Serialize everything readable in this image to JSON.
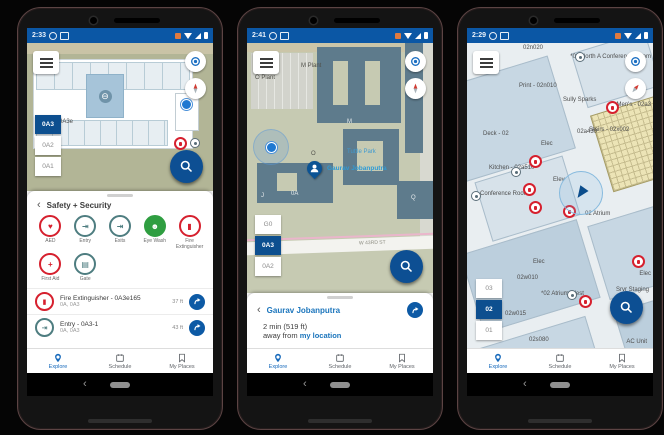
{
  "colors": {
    "status_bar_blue": "#0b57a5",
    "accent_blue": "#0d4f93",
    "nav_active_blue": "#1669bb",
    "poi_red": "#d6202e",
    "poi_teal": "#4e7d80",
    "poi_green": "#2f9e41",
    "person_label_blue": "#2e9bd6",
    "map_olive": "#b2b596",
    "campus_building": "#5e7b8c",
    "stairs_yellow": "#ece4b6"
  },
  "nav": {
    "explore": "Explore",
    "schedule": "Schedule",
    "my_places": "My Places"
  },
  "android": {
    "back_glyph": "‹"
  },
  "phones": [
    {
      "status": {
        "time": "2:33"
      },
      "map": {
        "room_label": "0A3e",
        "floors": {
          "f1": "0A3",
          "f2": "0A2",
          "f3": "0A1"
        }
      },
      "sheet": {
        "back_glyph": "‹",
        "title": "Safety + Security",
        "categories": [
          {
            "label": "AED",
            "glyph": "♥"
          },
          {
            "label": "Entry",
            "glyph": "⇥"
          },
          {
            "label": "Exits",
            "glyph": "⇥"
          },
          {
            "label": "Eye Wash",
            "glyph": "☻"
          },
          {
            "label": "Fire Extinguisher",
            "glyph": "▮"
          },
          {
            "label": "First Aid",
            "glyph": "+"
          },
          {
            "label": "Gate",
            "glyph": "▤"
          }
        ],
        "results": [
          {
            "title": "Fire Extinguisher - 0A3e165",
            "subtitle": "0A, 0A3",
            "distance": "37 ft",
            "glyph": "▮"
          },
          {
            "title": "Entry - 0A3-1",
            "subtitle": "0A, 0A3",
            "distance": "43 ft",
            "glyph": "⇥"
          }
        ]
      }
    },
    {
      "status": {
        "time": "2:41"
      },
      "map": {
        "labels": {
          "m_plant": "M Plant",
          "o_plant": "O Plant",
          "m": "M",
          "tuttle_park": "Tuttle Park",
          "oa": "0A",
          "o": "O",
          "j": "J",
          "q": "Q",
          "street": "W 43RD ST"
        },
        "pin_label": "Gaurav Jobanputra",
        "floors": {
          "f1": "G0",
          "f2": "0A3",
          "f3": "0A2"
        }
      },
      "sheet": {
        "back_glyph": "‹",
        "title": "Gaurav Jobanputra",
        "line1": "2 min (519 ft)",
        "line2_prefix": "away from",
        "line2_link": "my location"
      }
    },
    {
      "status": {
        "time": "2:29"
      },
      "map": {
        "labels": {
          "n020": "02n020",
          "north_conf": "*02 North A Conference Room",
          "print": "Print - 02n010",
          "sully": "Sully Sparks",
          "mens": "Men's - 02a3",
          "deck": "Deck - 02",
          "elec_a": "Elec",
          "a430": "02a430",
          "kitchen": "Kitchen - 02a510",
          "elev": "Elev",
          "stairs": "Stairs - 02x002",
          "atrium": "02 Atrium",
          "conf": "Conference Room",
          "elec_b": "Elec",
          "w010": "02w010",
          "atrium_west": "*02 Atrium West",
          "w015": "02w015",
          "srvr": "Srvr Staging",
          "s080": "02s080",
          "ac": "AC Unit",
          "elec_c": "Elec"
        },
        "floors": {
          "f1": "03",
          "f2": "02",
          "f3": "01"
        }
      }
    }
  ]
}
